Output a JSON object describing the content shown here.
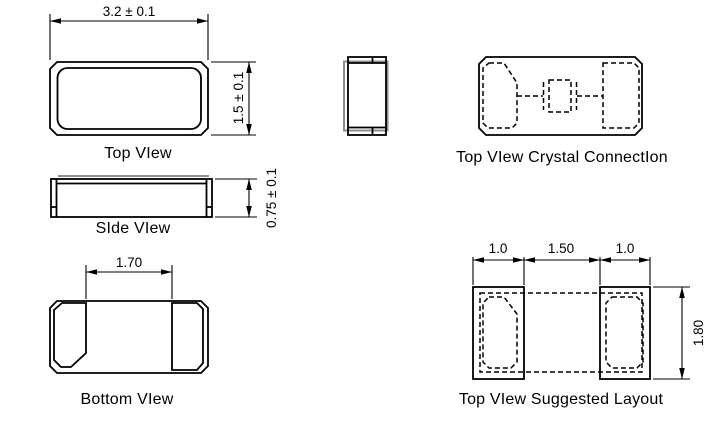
{
  "page": {
    "title": "Crystal package mechanical drawing"
  },
  "colors": {
    "line": "#000000",
    "lid_gray": "#8f8f8f",
    "background": "#ffffff"
  },
  "views": {
    "top_view": {
      "label": "Top VIew",
      "dim_width": "3.2 ± 0.1",
      "dim_height": "1.5 ± 0.1"
    },
    "side_view": {
      "label": "SIde VIew",
      "dim_height": "0.75 ± 0.1"
    },
    "bottom_view": {
      "label": "Bottom VIew",
      "dim_pad_gap": "1.70"
    },
    "crystal_connection": {
      "label": "Top VIew Crystal ConnectIon"
    },
    "suggested_layout": {
      "label": "Top VIew Suggested Layout",
      "dim_left_pad": "1.0",
      "dim_gap": "1.50",
      "dim_right_pad": "1.0",
      "dim_height": "1.80"
    }
  }
}
